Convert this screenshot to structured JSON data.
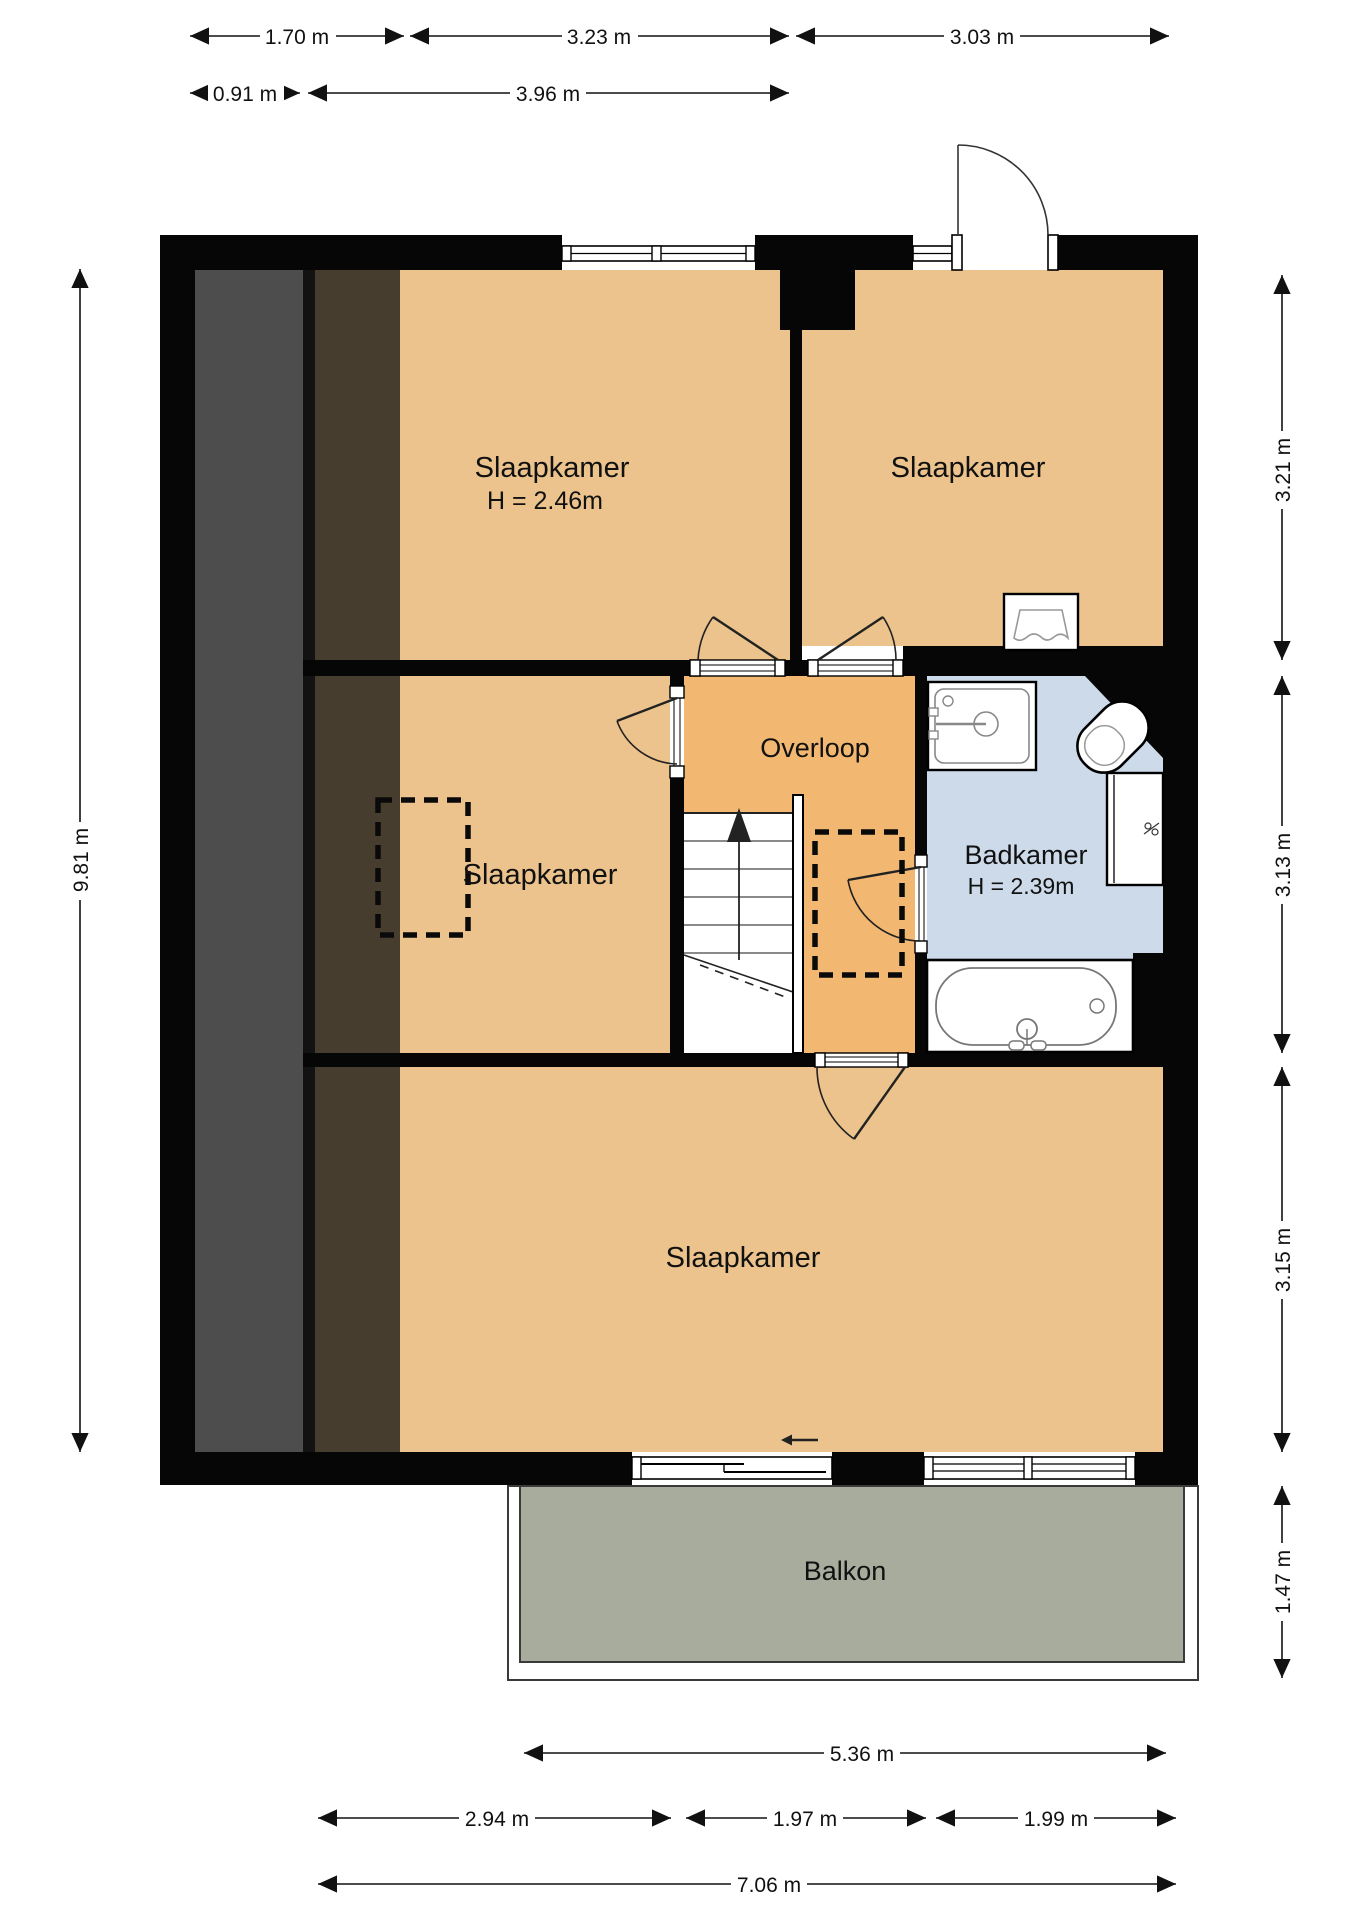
{
  "plan": {
    "type": "floorplan-first-floor",
    "rooms": [
      {
        "id": "bedroom-top-left",
        "label": "Slaapkamer",
        "height_label": "H = 2.46m"
      },
      {
        "id": "bedroom-top-right",
        "label": "Slaapkamer"
      },
      {
        "id": "bedroom-middle-left",
        "label": "Slaapkamer"
      },
      {
        "id": "landing",
        "label": "Overloop"
      },
      {
        "id": "bathroom",
        "label": "Badkamer",
        "height_label": "H = 2.39m"
      },
      {
        "id": "bedroom-bottom",
        "label": "Slaapkamer"
      },
      {
        "id": "balcony",
        "label": "Balkon"
      }
    ],
    "icons": [
      "sink-icon",
      "toilet-icon",
      "boiler-cabinet-icon",
      "bathtub-icon",
      "washbasin-icon",
      "stairs-up-arrow-icon",
      "entry-arrow-icon",
      "door-swing-icon",
      "window-icon",
      "skylight-dashed-icon"
    ],
    "colors": {
      "wall": "#060606",
      "bedroom_floor": "#ECC38C",
      "landing_floor": "#F2B872",
      "bathroom_floor": "#CCDAE9",
      "balcony_floor": "#A8AC9D",
      "sloped_roof_gray": "#4D4D4D",
      "sloped_roof_brown": "#463D2F",
      "fixture_white": "#FFFFFF",
      "text": "#111111"
    }
  },
  "dimensions": {
    "top_row1": [
      "1.70 m",
      "3.23 m",
      "3.03 m"
    ],
    "top_row2": [
      "0.91 m",
      "3.96 m"
    ],
    "left": [
      "9.81 m"
    ],
    "right": [
      "3.21 m",
      "3.13 m",
      "3.15 m",
      "1.47 m"
    ],
    "bottom_row1": [
      "5.36 m"
    ],
    "bottom_row2": [
      "2.94 m",
      "1.97 m",
      "1.99 m"
    ],
    "bottom_row3": [
      "7.06 m"
    ]
  }
}
